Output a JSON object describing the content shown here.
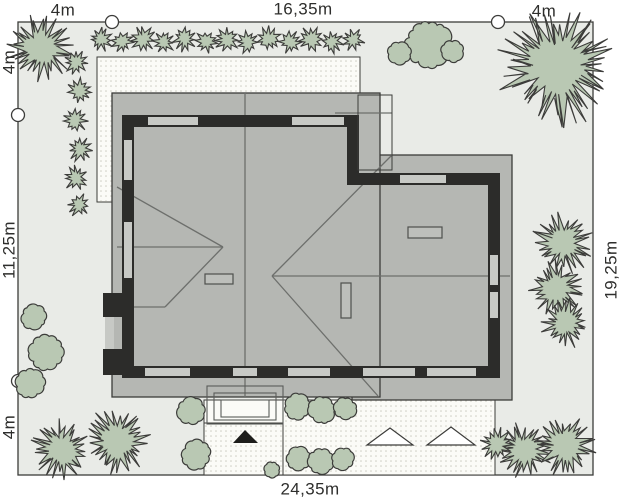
{
  "scene": {
    "width": 620,
    "height": 500
  },
  "colors": {
    "page_bg": "#ffffff",
    "plot_fill": "#e9ebe7",
    "outline": "#3c3c3a",
    "roof_fill": "#b5b7b3",
    "roof_line": "#6d6f6c",
    "wall_fill": "#2c2c2a",
    "window_fill": "#c7c9c5",
    "paving_fill": "#fbfbf7",
    "paving_dot": "#ccccc2",
    "tree_fill": "#b9c8b3",
    "tree_line": "#3c3c3a",
    "chimney_fill": "#bdbfbb",
    "chimney_line": "#4e504d",
    "step_line": "#5a5c59",
    "entry_arrow": "#1d1d1b",
    "text": "#2e2e2c"
  },
  "dims": {
    "top_left": "4m",
    "top_center": "16,35m",
    "top_right": "4m",
    "left_top": "4m",
    "left_middle": "11,25m",
    "left_bottom": "4m",
    "right_side": "19,25m",
    "bottom": "24,35m"
  },
  "plot": {
    "x": 18,
    "y": 22,
    "w": 575,
    "h": 453
  },
  "survey_points": [
    [
      112,
      22
    ],
    [
      498,
      22
    ],
    [
      18,
      115
    ],
    [
      18,
      381
    ]
  ],
  "paving": [
    {
      "name": "terrace",
      "x": 97,
      "y": 57,
      "w": 263,
      "h": 145,
      "dots": true
    },
    {
      "name": "entry-upper",
      "x": 204,
      "y": 400,
      "w": 79,
      "h": 23,
      "dots": false
    },
    {
      "name": "entry-lower",
      "x": 204,
      "y": 423,
      "w": 79,
      "h": 52,
      "dots": true
    },
    {
      "name": "driveway",
      "x": 283,
      "y": 400,
      "w": 212,
      "h": 75,
      "dots": true
    }
  ],
  "house": {
    "wing_roof": {
      "x": 352,
      "y": 155,
      "w": 160,
      "h": 245
    },
    "main_roof": {
      "x": 112,
      "y": 93,
      "w": 268,
      "h": 304
    },
    "canopy": {
      "x": 358,
      "y": 95,
      "w": 34,
      "h": 75
    },
    "roof_lines": [
      [
        245,
        93,
        245,
        397
      ],
      [
        117,
        247,
        223,
        247
      ],
      [
        117,
        187,
        223,
        247
      ],
      [
        165,
        307,
        223,
        247
      ],
      [
        117,
        307,
        165,
        307
      ],
      [
        272,
        276,
        510,
        276
      ],
      [
        272,
        276,
        392,
        155
      ],
      [
        272,
        276,
        378,
        396
      ],
      [
        335,
        113,
        392,
        113
      ]
    ],
    "wall_path": "M353,121 L128,121 L128,372 L494,372 L494,179 L353,179 Z",
    "wall_thickness": 12,
    "window_thickness": 8,
    "windows": [
      [
        148,
        121,
        198,
        121
      ],
      [
        292,
        121,
        344,
        121
      ],
      [
        128,
        140,
        128,
        180
      ],
      [
        128,
        222,
        128,
        278
      ],
      [
        400,
        179,
        446,
        179
      ],
      [
        494,
        255,
        494,
        285
      ],
      [
        494,
        292,
        494,
        318
      ],
      [
        145,
        372,
        190,
        372
      ],
      [
        233,
        372,
        257,
        372
      ],
      [
        288,
        372,
        330,
        372
      ],
      [
        363,
        372,
        415,
        372
      ],
      [
        427,
        372,
        476,
        372
      ]
    ],
    "bay_blocks": [
      [
        103,
        293,
        27,
        24
      ],
      [
        103,
        349,
        27,
        26
      ]
    ],
    "bay_windows": [
      [
        105,
        317,
        9,
        32
      ]
    ],
    "chimneys": [
      [
        205,
        274,
        28,
        10
      ],
      [
        408,
        227,
        34,
        11
      ],
      [
        341,
        283,
        10,
        35
      ]
    ],
    "steps": [
      [
        207,
        386,
        76,
        38
      ],
      [
        214,
        393,
        62,
        27
      ],
      [
        221,
        400,
        48,
        17
      ]
    ]
  },
  "markers": {
    "entry_triangle": [
      [
        233,
        443
      ],
      [
        258,
        443
      ],
      [
        245,
        430
      ]
    ],
    "drive_triangles": [
      [
        [
          367,
          445
        ],
        [
          413,
          445
        ],
        [
          390,
          428
        ]
      ],
      [
        [
          427,
          445
        ],
        [
          475,
          445
        ],
        [
          451,
          427
        ]
      ]
    ]
  },
  "trees": {
    "conifers": [
      {
        "cx": 40,
        "cy": 48,
        "r": 30
      },
      {
        "cx": 101,
        "cy": 39,
        "r": 12
      },
      {
        "cx": 122,
        "cy": 42,
        "r": 11
      },
      {
        "cx": 143,
        "cy": 39,
        "r": 12
      },
      {
        "cx": 164,
        "cy": 42,
        "r": 11
      },
      {
        "cx": 185,
        "cy": 39,
        "r": 12
      },
      {
        "cx": 206,
        "cy": 42,
        "r": 11
      },
      {
        "cx": 227,
        "cy": 39,
        "r": 12
      },
      {
        "cx": 248,
        "cy": 42,
        "r": 11
      },
      {
        "cx": 269,
        "cy": 39,
        "r": 12
      },
      {
        "cx": 290,
        "cy": 42,
        "r": 11
      },
      {
        "cx": 311,
        "cy": 39,
        "r": 12
      },
      {
        "cx": 332,
        "cy": 42,
        "r": 11
      },
      {
        "cx": 353,
        "cy": 40,
        "r": 11
      },
      {
        "cx": 76,
        "cy": 62,
        "r": 12
      },
      {
        "cx": 80,
        "cy": 91,
        "r": 12
      },
      {
        "cx": 75,
        "cy": 120,
        "r": 12
      },
      {
        "cx": 80,
        "cy": 149,
        "r": 12
      },
      {
        "cx": 76,
        "cy": 178,
        "r": 12
      },
      {
        "cx": 79,
        "cy": 205,
        "r": 11
      },
      {
        "cx": 557,
        "cy": 67,
        "r": 54
      },
      {
        "cx": 563,
        "cy": 243,
        "r": 28
      },
      {
        "cx": 557,
        "cy": 288,
        "r": 26
      },
      {
        "cx": 566,
        "cy": 323,
        "r": 23
      },
      {
        "cx": 524,
        "cy": 450,
        "r": 26
      },
      {
        "cx": 565,
        "cy": 446,
        "r": 28
      },
      {
        "cx": 497,
        "cy": 444,
        "r": 16
      },
      {
        "cx": 61,
        "cy": 449,
        "r": 28
      },
      {
        "cx": 117,
        "cy": 441,
        "r": 31
      }
    ],
    "clouds": [
      {
        "cx": 428,
        "cy": 44,
        "r": 27
      },
      {
        "cx": 400,
        "cy": 53,
        "r": 14
      },
      {
        "cx": 453,
        "cy": 51,
        "r": 13
      },
      {
        "cx": 34,
        "cy": 317,
        "r": 15
      },
      {
        "cx": 46,
        "cy": 352,
        "r": 21
      },
      {
        "cx": 30,
        "cy": 383,
        "r": 17
      },
      {
        "cx": 191,
        "cy": 411,
        "r": 16
      },
      {
        "cx": 196,
        "cy": 455,
        "r": 17
      },
      {
        "cx": 297,
        "cy": 407,
        "r": 15
      },
      {
        "cx": 322,
        "cy": 410,
        "r": 16
      },
      {
        "cx": 345,
        "cy": 408,
        "r": 13
      },
      {
        "cx": 298,
        "cy": 459,
        "r": 14
      },
      {
        "cx": 321,
        "cy": 461,
        "r": 15
      },
      {
        "cx": 343,
        "cy": 459,
        "r": 13
      },
      {
        "cx": 272,
        "cy": 470,
        "r": 9
      }
    ]
  }
}
